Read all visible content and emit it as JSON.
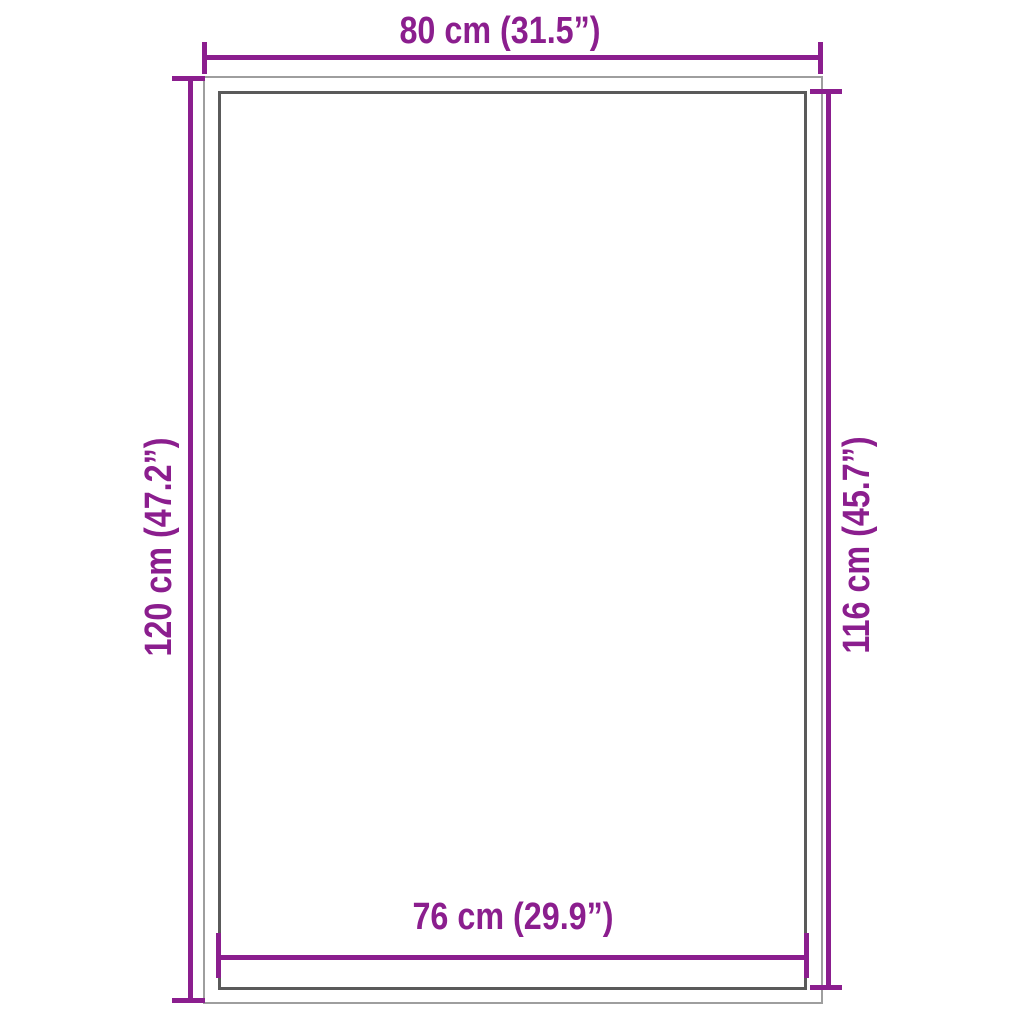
{
  "diagram": {
    "colors": {
      "background": "#ffffff",
      "accent": "#8b1e8e",
      "outer-line": "#9e9e9e",
      "inner-line": "#5a5a5a"
    },
    "dimensions": {
      "top": "80 cm (31.5”)",
      "left": "120 cm (47.2”)",
      "right": "116 cm (45.7”)",
      "bottom": "76 cm (29.9”)"
    }
  }
}
